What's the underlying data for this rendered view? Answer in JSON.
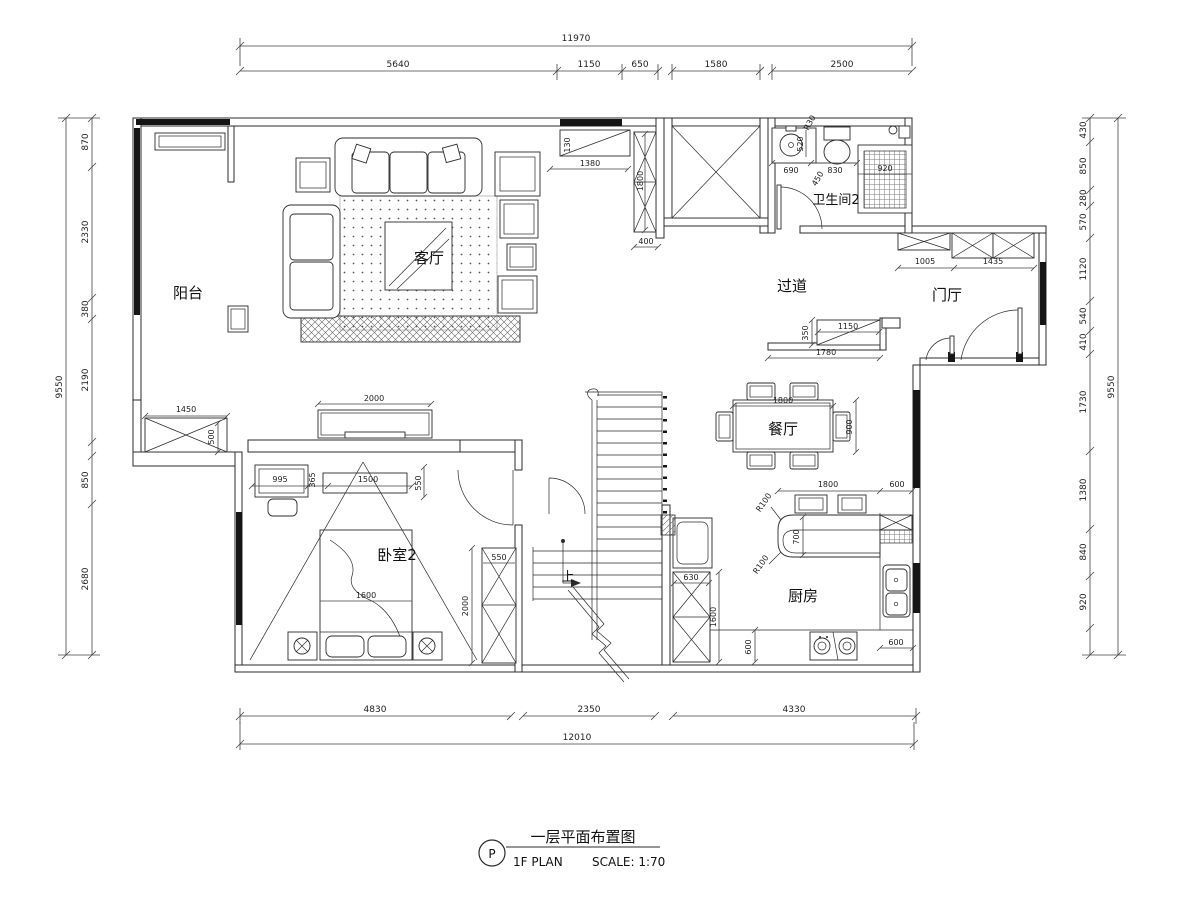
{
  "rooms": {
    "balcony": "阳台",
    "living": "客厅",
    "hallway": "过道",
    "bathroom2": "卫生间2",
    "foyer": "门厅",
    "dining": "餐厅",
    "bedroom2": "卧室2",
    "kitchen": "厨房"
  },
  "stairs": {
    "up_label": "上"
  },
  "dims": {
    "top": {
      "total": "11970",
      "segs": [
        "5640",
        "1150",
        "650",
        "1580",
        "2500"
      ]
    },
    "bottom": {
      "total": "12010",
      "segs": [
        "4830",
        "2350",
        "4330"
      ]
    },
    "left": {
      "total": "9550",
      "segs": [
        "870",
        "2330",
        "380",
        "2190",
        "850",
        "2680"
      ]
    },
    "right": {
      "total": "9550",
      "segs": [
        "430",
        "850",
        "280",
        "570",
        "1120",
        "540",
        "410",
        "1730",
        "1380",
        "840",
        "920"
      ]
    },
    "interior": {
      "sideboard_h": "130",
      "sideboard_w": "1380",
      "cabinet_h": "1800",
      "shaft_offset": "400",
      "bath_sink": "690",
      "bath_mid": "450",
      "bath_wc": "830",
      "bath_shower": "920",
      "bath_depth": "520",
      "bath_r": "R30",
      "hall_cab_a": "1005",
      "hall_cab_b": "1435",
      "shoe_d": "350",
      "shoe_w": "1150",
      "hall_w": "1780",
      "dining_w": "1800",
      "dining_d": "900",
      "bar_w": "1800",
      "bar_gap": "600",
      "bar_d": "700",
      "bar_r1": "R100",
      "bar_r2": "R100",
      "k_cab": "630",
      "k_h": "1600",
      "k_d": "600",
      "k_gap": "600",
      "tv_w": "2000",
      "balc_cab_w": "1450",
      "balc_cab_d": "500",
      "bed_a": "995",
      "bed_b": "365",
      "bed_c": "1500",
      "bed_d": "550",
      "bed_w": "1600",
      "ward_w": "550",
      "ward_h": "2000"
    }
  },
  "title_block": {
    "tag": "P",
    "title": "一层平面布置图",
    "subtitle": "1F PLAN",
    "scale": "SCALE: 1:70"
  }
}
